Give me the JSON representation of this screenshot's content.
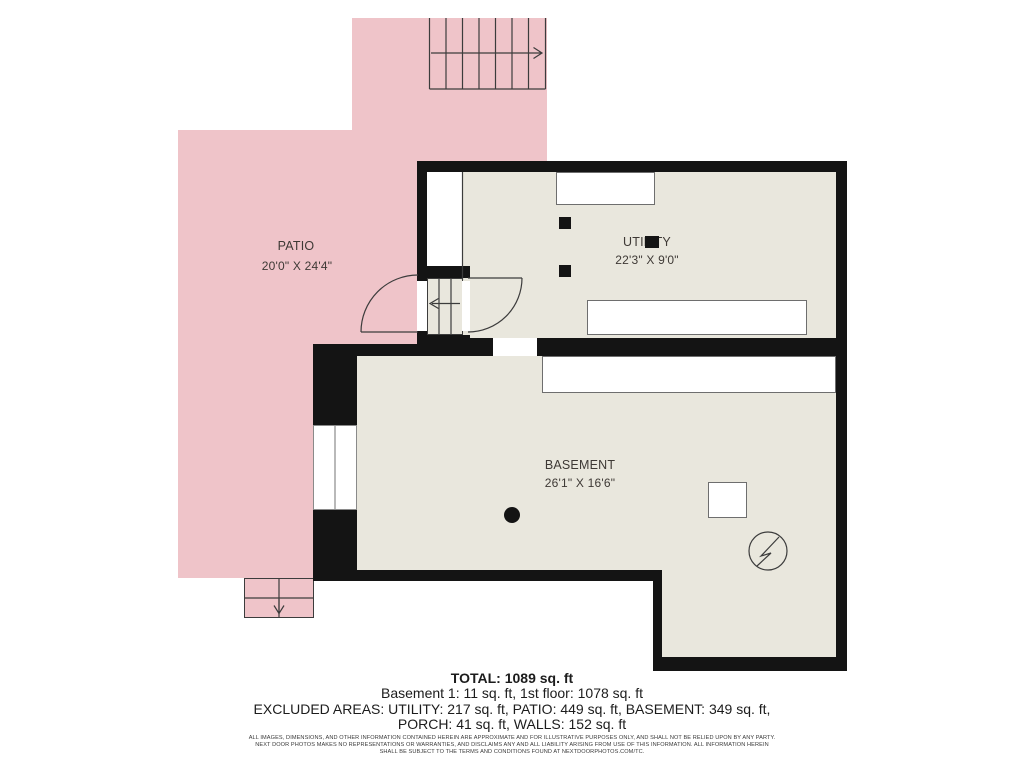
{
  "colors": {
    "pink": "#efc4c9",
    "room": "#e9e7dd",
    "wall": "#141414",
    "line": "#3c3c3c",
    "label": "#3e3935",
    "fixture-border": "#6e6e6e",
    "text": "#1c1c1c"
  },
  "floorplan": {
    "rooms": [
      {
        "name": "PATIO",
        "dims": "20'0\" X 24'4\""
      },
      {
        "name": "UTILITY",
        "dims": "22'3\" X 9'0\""
      },
      {
        "name": "BASEMENT",
        "dims": "26'1\" X 16'6\""
      }
    ]
  },
  "summary": {
    "total": "TOTAL: 1089 sq. ft",
    "floors": "Basement 1: 11 sq. ft, 1st floor: 1078 sq. ft",
    "excluded_1": "EXCLUDED AREAS: UTILITY: 217 sq. ft, PATIO: 449 sq. ft, BASEMENT: 349 sq. ft,",
    "excluded_2": "PORCH: 41 sq. ft, WALLS: 152 sq. ft"
  },
  "disclaimer": {
    "line1": "ALL IMAGES, DIMENSIONS, AND OTHER INFORMATION CONTAINED HEREIN ARE APPROXIMATE AND FOR ILLUSTRATIVE PURPOSES ONLY, AND SHALL NOT BE RELIED UPON BY ANY PARTY.",
    "line2": "NEXT DOOR PHOTOS MAKES NO REPRESENTATIONS OR WARRANTIES, AND DISCLAIMS ANY AND ALL LIABILITY ARISING FROM USE OF THIS INFORMATION. ALL INFORMATION HEREIN",
    "line3": "SHALL BE SUBJECT TO THE TERMS AND CONDITIONS FOUND AT NEXTDOORPHOTOS.COM/TC."
  }
}
